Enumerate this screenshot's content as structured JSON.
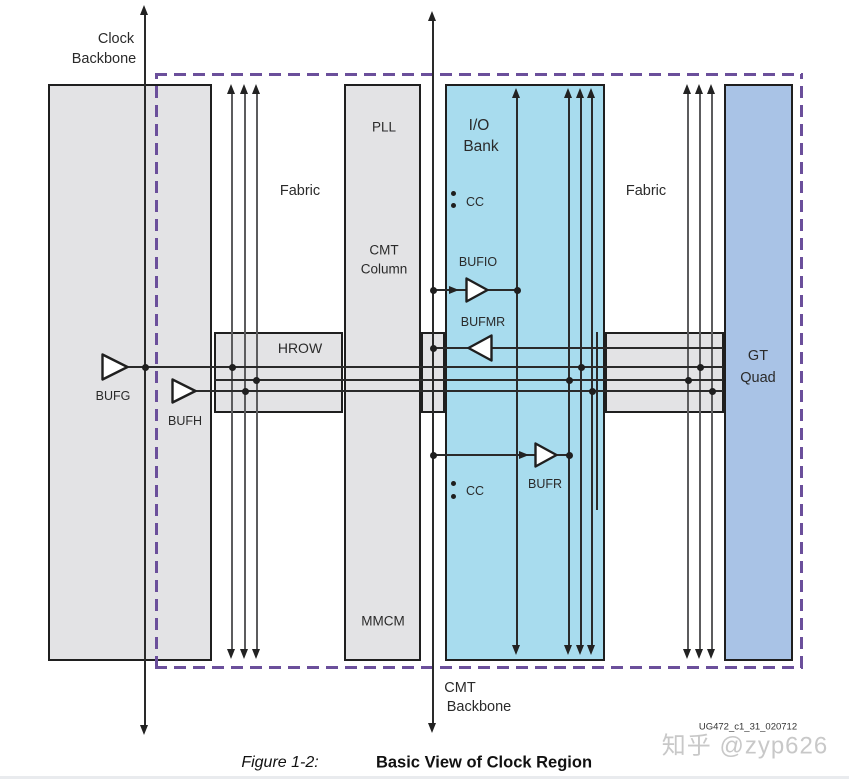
{
  "figure": {
    "caption_label": "Figure 1-2:",
    "caption_title": "Basic View of Clock Region",
    "reference": "UG472_c1_31_020712",
    "watermark": "知乎 @zyp626"
  },
  "labels": {
    "clock_backbone_line1": "Clock",
    "clock_backbone_line2": "Backbone",
    "fabric_left": "Fabric",
    "fabric_right": "Fabric",
    "pll": "PLL",
    "mmcm": "MMCM",
    "cmt_column_line1": "CMT",
    "cmt_column_line2": "Column",
    "io_bank_line1": "I/O",
    "io_bank_line2": "Bank",
    "hrow": "HROW",
    "gt_quad_line1": "GT",
    "gt_quad_line2": "Quad",
    "bufg": "BUFG",
    "bufh": "BUFH",
    "bufio": "BUFIO",
    "bufmr": "BUFMR",
    "bufr": "BUFR",
    "cc_top": "CC",
    "cc_bottom": "CC",
    "cmt_backbone_line1": "CMT",
    "cmt_backbone_line2": "Backbone"
  },
  "colors": {
    "block_gray": "#e3e3e5",
    "io_bank_cyan": "#a8dcee",
    "gt_quad_blue": "#a9c3e6",
    "region_border_purple": "#6b4f9b",
    "line_ink": "#2a2a2a",
    "watermark_gray": "#c8c8c8"
  }
}
